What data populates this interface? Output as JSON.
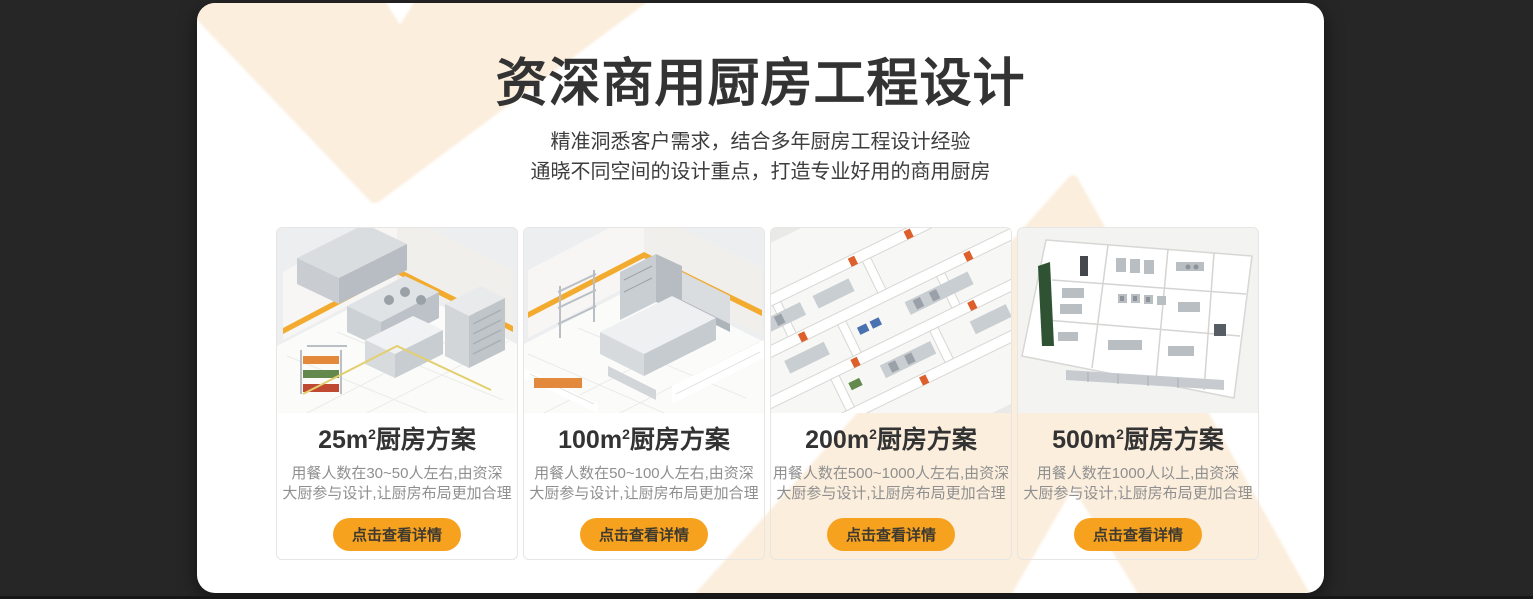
{
  "theme": {
    "background_color": "#262626",
    "panel_color": "#ffffff",
    "chevron_color": "#fbeedd",
    "button_color": "#f7a21f",
    "title_color": "#333333",
    "description_color": "#8f8f8f"
  },
  "header": {
    "title": "资深商用厨房工程设计",
    "subtitle_line1": "精准洞悉客户需求，结合多年厨房工程设计经验",
    "subtitle_line2": "通晓不同空间的设计重点，打造专业好用的商用厨房"
  },
  "cards": [
    {
      "title_area": "25m",
      "title_sup": "2",
      "title_suffix": "厨房方案",
      "desc_line1": "用餐人数在30~50人左右,由资深",
      "desc_line2": "大厨参与设计,让厨房布局更加合理",
      "button_label": "点击查看详情",
      "image_alt": "isometric-render-25m2-kitchen"
    },
    {
      "title_area": "100m",
      "title_sup": "2",
      "title_suffix": "厨房方案",
      "desc_line1": "用餐人数在50~100人左右,由资深",
      "desc_line2": "大厨参与设计,让厨房布局更加合理",
      "button_label": "点击查看详情",
      "image_alt": "isometric-render-100m2-kitchen"
    },
    {
      "title_area": "200m",
      "title_sup": "2",
      "title_suffix": "厨房方案",
      "desc_line1": "用餐人数在500~1000人左右,由资深",
      "desc_line2": "大厨参与设计,让厨房布局更加合理",
      "button_label": "点击查看详情",
      "image_alt": "isometric-render-200m2-kitchen"
    },
    {
      "title_area": "500m",
      "title_sup": "2",
      "title_suffix": "厨房方案",
      "desc_line1": "用餐人数在1000人以上,由资深",
      "desc_line2": "大厨参与设计,让厨房布局更加合理",
      "button_label": "点击查看详情",
      "image_alt": "floorplan-render-500m2-kitchen"
    }
  ]
}
